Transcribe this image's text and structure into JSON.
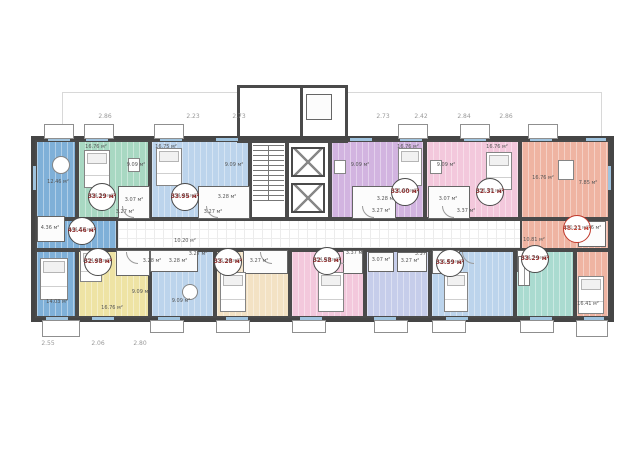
{
  "title": "Residential floor plan (typical floor, double-loaded corridor)",
  "units": [
    {
      "name": "1-bedroom west corner",
      "color": "#7fb0d8",
      "area": "43.46 м²",
      "area_total": "(44.73 м²)"
    },
    {
      "name": "studio green",
      "color": "#a8d8c2",
      "area": "33.29 м²",
      "area_total": "(34.34 м²)"
    },
    {
      "name": "studio light-blue north",
      "color": "#bcd4ec",
      "area": "33.95 м²",
      "area_total": "(34.93 м²)"
    },
    {
      "name": "studio purple",
      "color": "#d2b4e0",
      "area": "33.00 м²",
      "area_total": "(33.97 м²)"
    },
    {
      "name": "studio pink north",
      "color": "#f3c8dc",
      "area": "32.31 м²",
      "area_total": "(33.79 м²)"
    },
    {
      "name": "1-bedroom east corner",
      "color": "#efb4a2",
      "area": "48.21 м²",
      "area_total": "(50.13 м²)"
    },
    {
      "name": "studio yellow",
      "color": "#eee3a4",
      "area": "32.98 м²",
      "area_total": "(34.95 м²)"
    },
    {
      "name": "studio peach",
      "color": "#f3e2c4",
      "area": "33.28 м²",
      "area_total": "(35.16 м²)"
    },
    {
      "name": "studio pink south",
      "color": "#f3c8dc",
      "area": "32.58 м²",
      "area_total": "(34.05 м²)"
    },
    {
      "name": "studio light-blue south",
      "color": "#bcd4ec",
      "area": "33.59 м²",
      "area_total": "(35.54 м²)"
    },
    {
      "name": "studio teal",
      "color": "#aadbd0",
      "area": "33.29 м²",
      "area_total": "(34.74 м²)"
    }
  ],
  "room_labels": [
    {
      "text": "12.46 м²"
    },
    {
      "text": "4.36 м²"
    },
    {
      "text": "10.20 м²"
    },
    {
      "text": "16.76 м²"
    },
    {
      "text": "9.09 м²"
    },
    {
      "text": "3.07 м²"
    },
    {
      "text": "3.27 м²"
    },
    {
      "text": "16.75 м²"
    },
    {
      "text": "9.09 м²"
    },
    {
      "text": "3.28 м²"
    },
    {
      "text": "3.27 м²"
    },
    {
      "text": "9.09 м²"
    },
    {
      "text": "16.76 м²"
    },
    {
      "text": "3.28 м²"
    },
    {
      "text": "3.27 м²"
    },
    {
      "text": "9.09 м²"
    },
    {
      "text": "16.76 м²"
    },
    {
      "text": "3.07 м²"
    },
    {
      "text": "3.37 м²"
    },
    {
      "text": "7.85 м²"
    },
    {
      "text": "16.76 м²"
    },
    {
      "text": "4.86 м²"
    },
    {
      "text": "10.81 м²"
    },
    {
      "text": "16.41 м²"
    },
    {
      "text": "14.03 м²"
    },
    {
      "text": "16.76 м²"
    },
    {
      "text": "9.09 м²"
    },
    {
      "text": "9.09 м²"
    },
    {
      "text": "3.28 м²"
    },
    {
      "text": "3.28 м²"
    },
    {
      "text": "3.27 м²"
    },
    {
      "text": "3.27 м²"
    },
    {
      "text": "3.37 м²"
    },
    {
      "text": "3.07 м²"
    },
    {
      "text": "3.27 м²"
    },
    {
      "text": "3.37 м²"
    }
  ],
  "dims_top": [
    "2.86",
    "2.23",
    "2.73",
    "2.73",
    "2.42",
    "2.84",
    "2.86"
  ],
  "dims_bottom": [
    "2.55",
    "2.06",
    "2.80"
  ],
  "colors": {
    "wall": "#4a4a4a",
    "corridor_grid": "#ececec",
    "badge_area_text": "#8b2323",
    "badge_highlight": "#c0392b",
    "window": "#9fc3de"
  }
}
